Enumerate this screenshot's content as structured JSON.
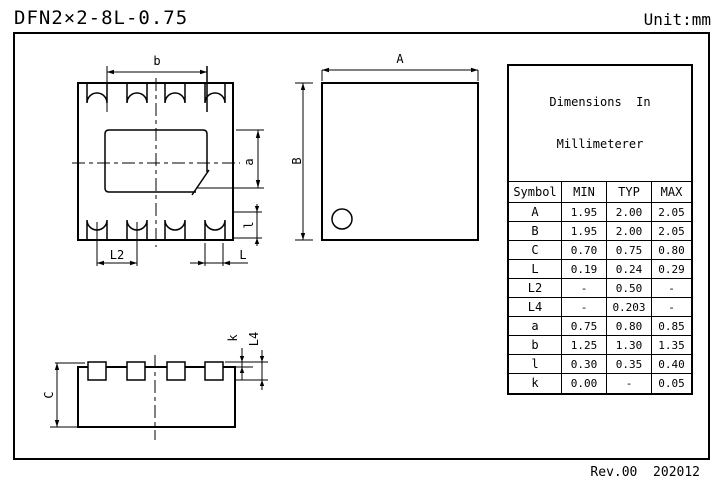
{
  "header": {
    "title": "DFN2×2-8L-0.75",
    "unit_label": "Unit:mm"
  },
  "footer": {
    "revision": "Rev.00  202012"
  },
  "colors": {
    "line": "#000000",
    "background": "#ffffff"
  },
  "views": {
    "bottom_view": {
      "dim_labels": {
        "b": "b",
        "a": "a",
        "l_small": "l",
        "l2": "L2",
        "l_cap": "L"
      }
    },
    "top_view": {
      "dim_labels": {
        "a_cap": "A",
        "b_cap": "B"
      }
    },
    "side_view": {
      "dim_labels": {
        "c": "C",
        "k": "k",
        "l4": "L4"
      }
    }
  },
  "table": {
    "title_line1": "Dimensions  In",
    "title_line2": "Millimeterer",
    "columns": [
      "Symbol",
      "MIN",
      "TYP",
      "MAX"
    ],
    "rows": [
      {
        "symbol": "A",
        "min": "1.95",
        "typ": "2.00",
        "max": "2.05"
      },
      {
        "symbol": "B",
        "min": "1.95",
        "typ": "2.00",
        "max": "2.05"
      },
      {
        "symbol": "C",
        "min": "0.70",
        "typ": "0.75",
        "max": "0.80"
      },
      {
        "symbol": "L",
        "min": "0.19",
        "typ": "0.24",
        "max": "0.29"
      },
      {
        "symbol": "L2",
        "min": "-",
        "typ": "0.50",
        "max": "-"
      },
      {
        "symbol": "L4",
        "min": "-",
        "typ": "0.203",
        "max": "-"
      },
      {
        "symbol": "a",
        "min": "0.75",
        "typ": "0.80",
        "max": "0.85"
      },
      {
        "symbol": "b",
        "min": "1.25",
        "typ": "1.30",
        "max": "1.35"
      },
      {
        "symbol": "l",
        "min": "0.30",
        "typ": "0.35",
        "max": "0.40"
      },
      {
        "symbol": "k",
        "min": "0.00",
        "typ": "-",
        "max": "0.05"
      }
    ]
  }
}
